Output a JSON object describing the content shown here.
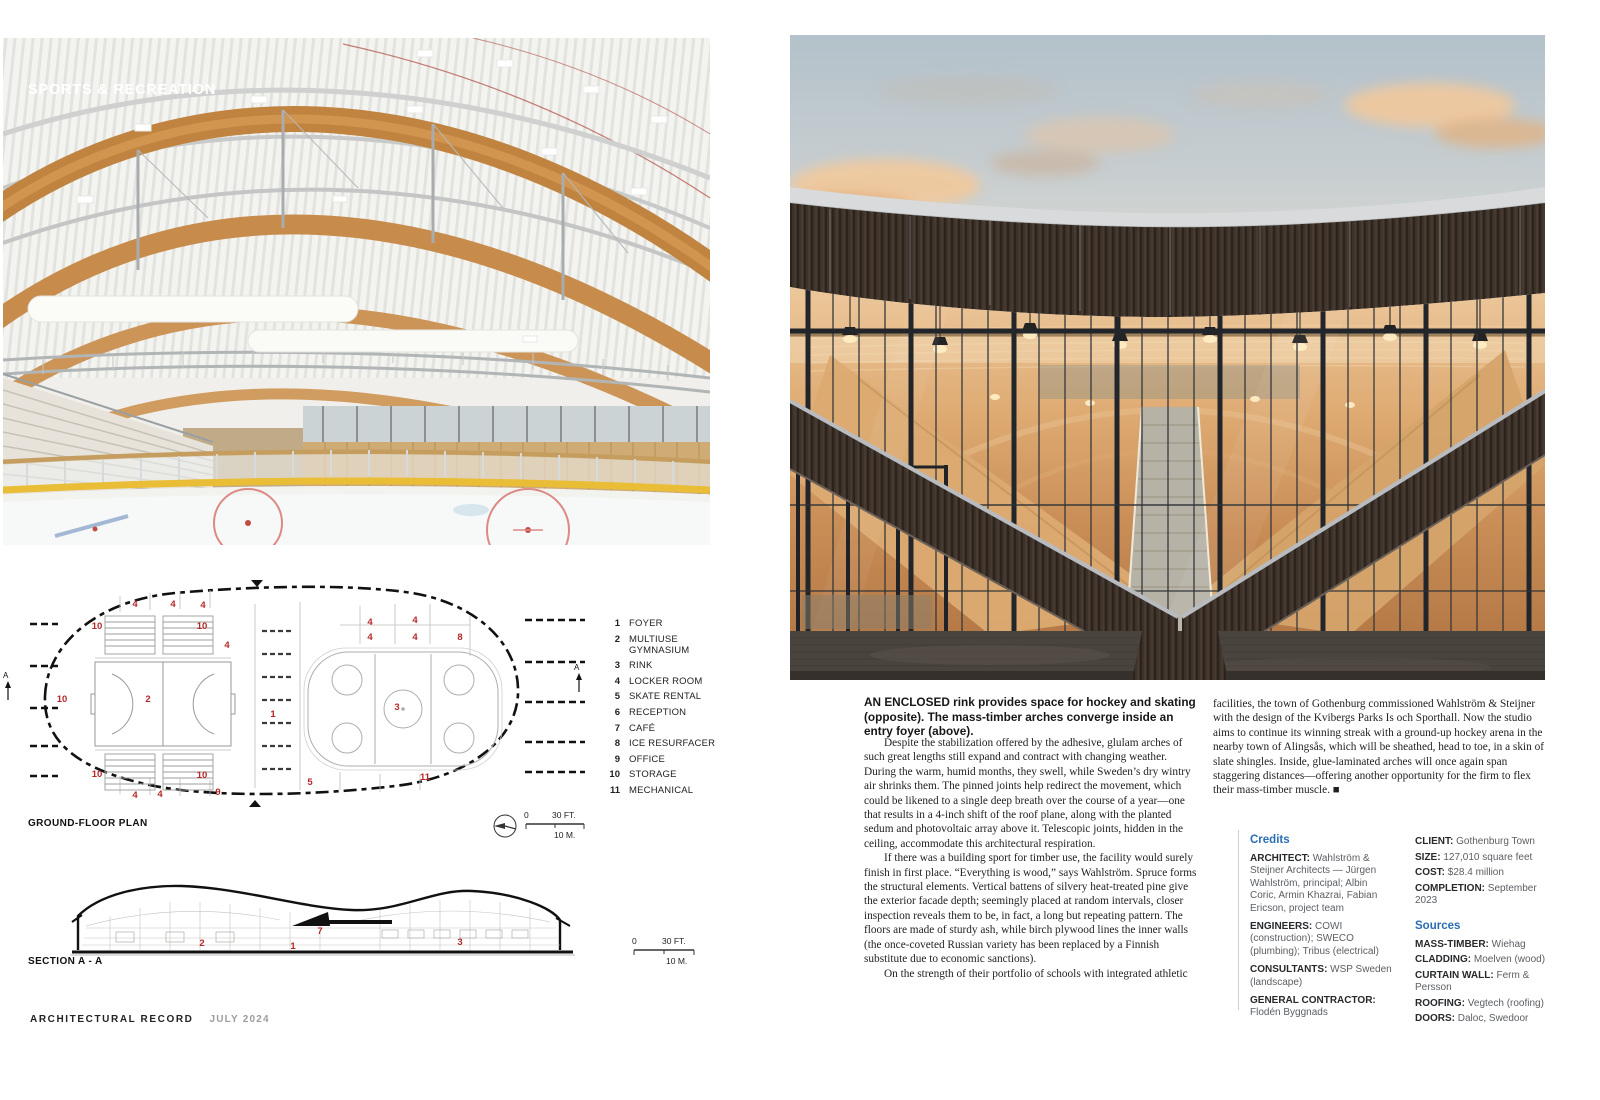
{
  "page": {
    "kicker": "SPORTS & RECREATION",
    "footer_magazine": "ARCHITECTURAL RECORD",
    "footer_issue": "JULY 2024"
  },
  "caption": {
    "lead": "AN ENCLOSED",
    "rest": " rink provides space for hockey and skating (opposite). The mass-timber arches converge inside an entry foyer (above)."
  },
  "article": {
    "col1": [
      {
        "text": "Despite the stabilization offered by the adhesive, glulam arches of such great lengths still expand and contract with changing weather. During the warm, humid months, they swell, while Sweden’s dry wintry air shrinks them. The pinned joints help redirect the movement, which could be likened to a single deep breath over the course of a year—one that results in a 4-inch shift of the roof plane, along with the planted sedum and photovoltaic array above it. Telescopic joints, hidden in the ceiling, accommodate this architectural respiration."
      },
      {
        "text": "If there was a building sport for timber use, the facility would surely finish in first place. “Everything is wood,” says Wahlström. Spruce forms the structural elements. Vertical battens of silvery heat-treated pine give the exterior facade depth; seemingly placed at random intervals, closer inspection reveals them to be, in fact, a long but repeating pattern. The floors are made of sturdy ash, while birch plywood lines the inner walls (the once-coveted Russian variety has been replaced by a Finnish substitute due to economic sanctions)."
      },
      {
        "text": "On the strength of their portfolio of schools with integrated athletic"
      }
    ],
    "col2": [
      {
        "text": "facilities, the town of Gothenburg commissioned Wahlström & Steijner with the design of the Kvibergs Parks Is och Sporthall. Now the studio aims to continue its winning streak with a ground-up hockey arena in the nearby town of Alingsås, which will be sheathed, head to toe, in a skin of slate shingles. Inside, glue-laminated arches will once again span staggering distances—offering another opportunity for the firm to flex their mass-timber muscle. ■"
      }
    ]
  },
  "credits": {
    "heading": "Credits",
    "items": [
      {
        "label": "ARCHITECT:",
        "text": " Wahlström & Steijner Architects — Jürgen Wahlström, principal; Albin Coric, Armin Khazrai, Fabian Ericson, project team"
      },
      {
        "label": "ENGINEERS:",
        "text": " COWI (construction); SWECO (plumbing); Tribus (electrical)"
      },
      {
        "label": "CONSULTANTS:",
        "text": " WSP Sweden (landscape)"
      },
      {
        "label": "GENERAL CONTRACTOR:",
        "text": " Flodén Byggnads"
      }
    ]
  },
  "facts": {
    "items": [
      {
        "label": "CLIENT:",
        "text": " Gothenburg Town"
      },
      {
        "label": "SIZE:",
        "text": " 127,010 square feet"
      },
      {
        "label": "COST:",
        "text": " $28.4 million"
      },
      {
        "label": "COMPLETION:",
        "text": " September 2023"
      }
    ],
    "sources_heading": "Sources",
    "sources": [
      {
        "label": "MASS-TIMBER:",
        "text": " Wiehag"
      },
      {
        "label": "CLADDING:",
        "text": " Moelven (wood)"
      },
      {
        "label": "CURTAIN WALL:",
        "text": " Ferm & Persson"
      },
      {
        "label": "ROOFING:",
        "text": " Vegtech (roofing)"
      },
      {
        "label": "DOORS:",
        "text": " Daloc, Swedoor"
      }
    ]
  },
  "drawings": {
    "plan_title": "GROUND-FLOOR PLAN",
    "section_title": "SECTION A - A",
    "scale_zero": "0",
    "scale_feet": "30 FT.",
    "scale_meters": "10 M.",
    "section_marker": "A",
    "legend": [
      {
        "num": "1",
        "label": "FOYER"
      },
      {
        "num": "2",
        "label": "MULTIUSE GYMNASIUM"
      },
      {
        "num": "3",
        "label": "RINK"
      },
      {
        "num": "4",
        "label": "LOCKER ROOM"
      },
      {
        "num": "5",
        "label": "SKATE RENTAL"
      },
      {
        "num": "6",
        "label": "RECEPTION"
      },
      {
        "num": "7",
        "label": "CAFÉ"
      },
      {
        "num": "8",
        "label": "ICE RESURFACER"
      },
      {
        "num": "9",
        "label": "OFFICE"
      },
      {
        "num": "10",
        "label": "STORAGE"
      },
      {
        "num": "11",
        "label": "MECHANICAL"
      }
    ],
    "plan_labels": [
      "4",
      "4",
      "4",
      "10",
      "10",
      "4",
      "4",
      "4",
      "4",
      "4",
      "8",
      "10",
      "2",
      "1",
      "3",
      "10",
      "10",
      "5",
      "11",
      "9",
      "4",
      "4"
    ],
    "section_labels": [
      "2",
      "1",
      "7",
      "3"
    ]
  },
  "colors": {
    "accent_blue": "#2a6db5",
    "plan_label_red": "#b5282a",
    "timber": "#c08440",
    "dark_cladding": "#3d322a"
  }
}
